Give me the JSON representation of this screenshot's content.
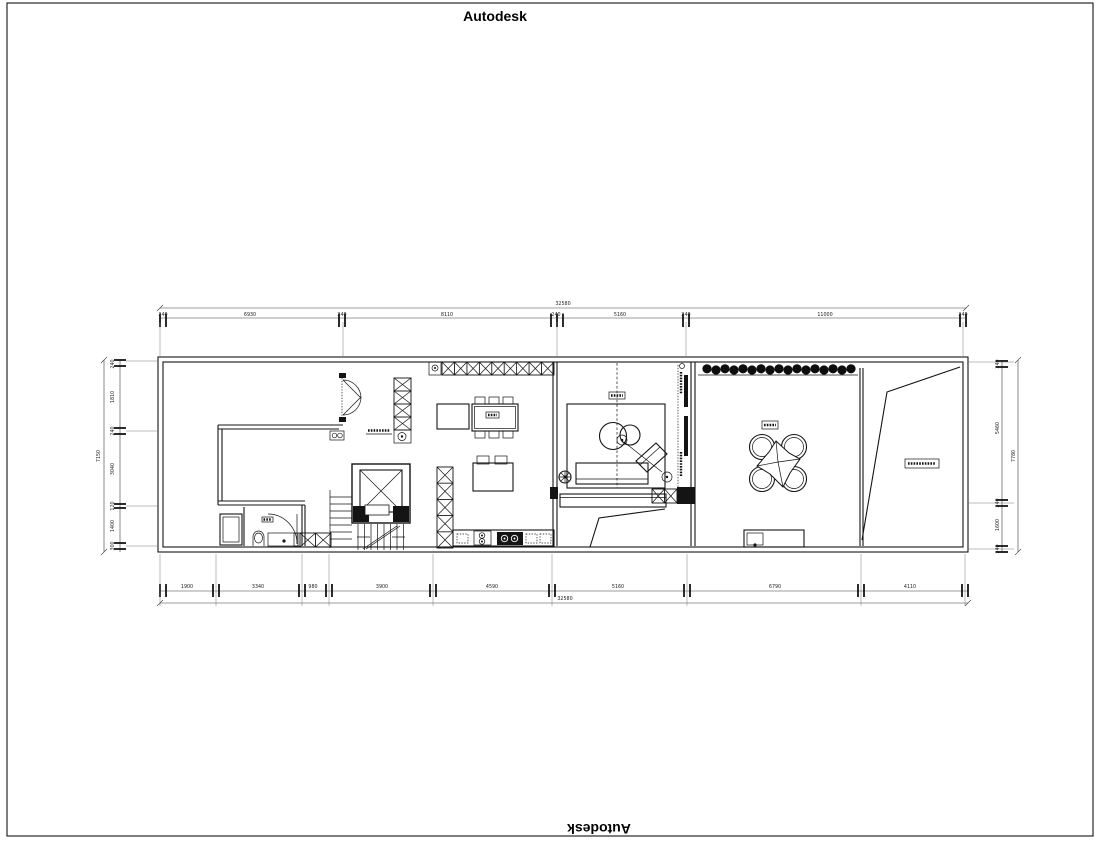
{
  "brand": {
    "top": "Autodesk",
    "bottom": "Autodesk"
  },
  "dims": {
    "top_total": "32580",
    "top_segments": [
      "240",
      "6930",
      "240",
      "8110",
      "240",
      "5160",
      "240",
      "11000",
      "240"
    ],
    "bottom_total": "32580",
    "bottom_segments": [
      "1900",
      "3340",
      "980",
      "3900",
      "4590",
      "5160",
      "6790",
      "4110"
    ],
    "left_total": "7150",
    "left_segments": [
      "240",
      "1810",
      "240",
      "3040",
      "120",
      "1400",
      "300"
    ],
    "right_total": "7780",
    "right_segments": [
      "240",
      "5460",
      "240",
      "1600",
      "240"
    ]
  }
}
